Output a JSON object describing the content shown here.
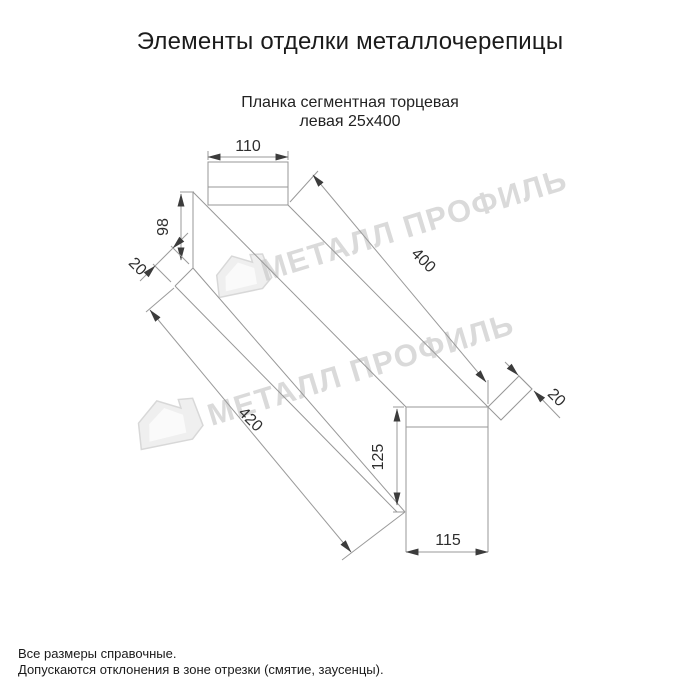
{
  "header": {
    "title": "Элементы отделки металлочерепицы"
  },
  "drawing": {
    "subtitle_line1": "Планка сегментная торцевая",
    "subtitle_line2": "левая 25х400",
    "dimensions": {
      "top_width": "110",
      "left_height": "98",
      "left_flange": "20",
      "length": "400",
      "total_length": "420",
      "right_flange": "20",
      "right_height": "125",
      "bottom_width": "115"
    }
  },
  "watermark": {
    "text": "МЕТАЛЛ ПРОФИЛЬ"
  },
  "footer": {
    "line1": "Все размеры справочные.",
    "line2": "Допускаются отклонения в зоне отрезки (смятие, заусенцы)."
  },
  "colors": {
    "line": "#979797",
    "dimension_text": "#2e2e2e",
    "title_text": "#1b1b1b",
    "watermark": "#cccccc",
    "background": "#ffffff"
  }
}
